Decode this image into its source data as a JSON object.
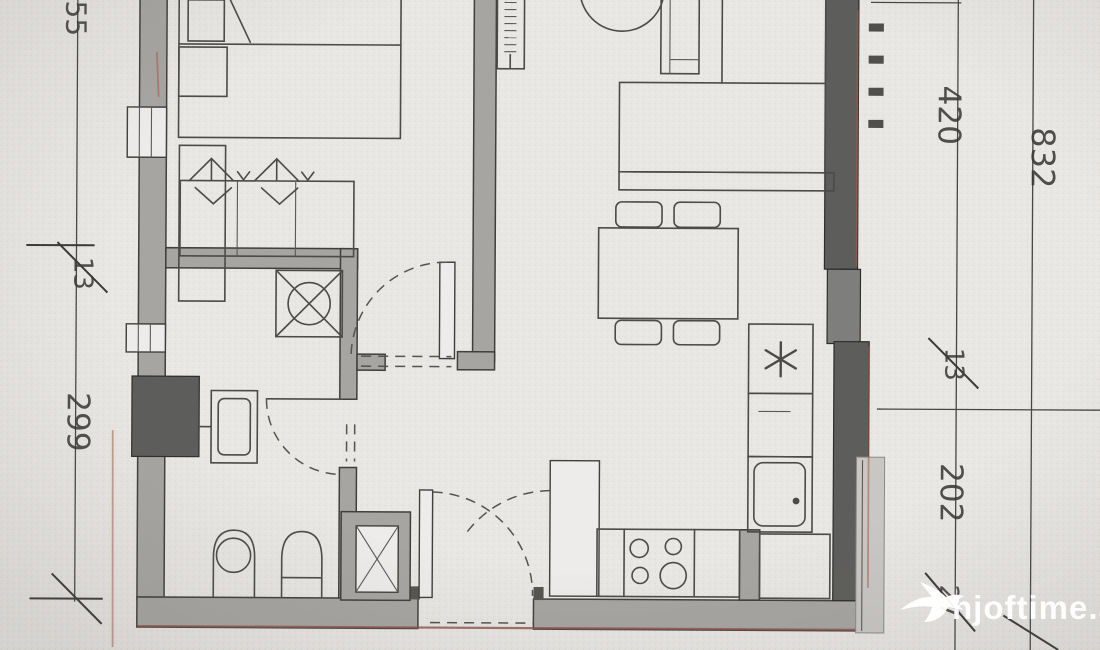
{
  "document": {
    "type": "apartment-floor-plan-photo",
    "watermark": {
      "text": "hjoftime.al",
      "logo": "swallow-bird-icon",
      "color": "#ffffff"
    }
  },
  "dimensions": {
    "left_line": {
      "seg_top": "55",
      "seg_mid": "13",
      "seg_main": "299",
      "crossed_labels": [
        "13"
      ]
    },
    "right_inner_line": {
      "seg1": "420",
      "seg2": "13",
      "seg3": "202",
      "seg4": "27",
      "crossed_labels": [
        "13",
        "27"
      ]
    },
    "right_outer_line": {
      "total": "832"
    }
  },
  "fixtures": {
    "bedroom": [
      "bed",
      "pillow",
      "nightstand",
      "wardrobe-with-hangers"
    ],
    "bathroom": [
      "washbasin",
      "shower-tray",
      "bidet",
      "toilet",
      "duct-shaft"
    ],
    "living": [
      "corner-sofa",
      "dining-table",
      "chairs",
      "plant-circle",
      "radiator"
    ],
    "kitchen": [
      "fridge-asterisk",
      "sink-basin",
      "stove-4-burners",
      "tall-cabinet"
    ],
    "doors": [
      "entry-door",
      "bedroom-door",
      "bathroom-door"
    ]
  },
  "colors": {
    "paper": "#e8e6e3",
    "wall": "#a6a5a2",
    "wall_dark": "#5d5d5b",
    "line": "#4b4b49",
    "accent_red": "#a85a4c",
    "watermark": "#ffffff"
  }
}
